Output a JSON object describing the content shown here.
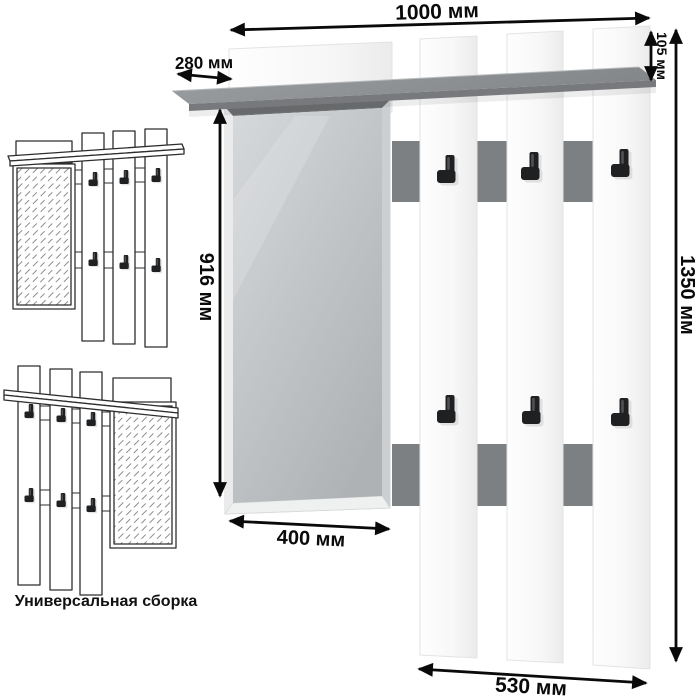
{
  "dimensions": {
    "total_width": "1000 мм",
    "shelf_depth": "280 мм",
    "shelf_offset_height": "105 мм",
    "mirror_height": "916 мм",
    "total_height": "1350 мм",
    "mirror_width": "400 мм",
    "hook_section_width": "530 мм"
  },
  "caption": "Универсальная сборка",
  "colors": {
    "shelf-top-light": "#9b9ea1",
    "shelf-top-dark": "#84878a",
    "shelf-front": "#77797c",
    "accent-strip": "#7c8083",
    "mirror-light": "#d6d9db",
    "mirror-dark": "#aeb2b5",
    "mirror-bevel": "#6f7274",
    "panel-edge": "#e2e3e3",
    "hook-black": "#1f2022",
    "dimension-ink": "#0a0a0a",
    "sketch-ink": "#2e2e2e"
  }
}
